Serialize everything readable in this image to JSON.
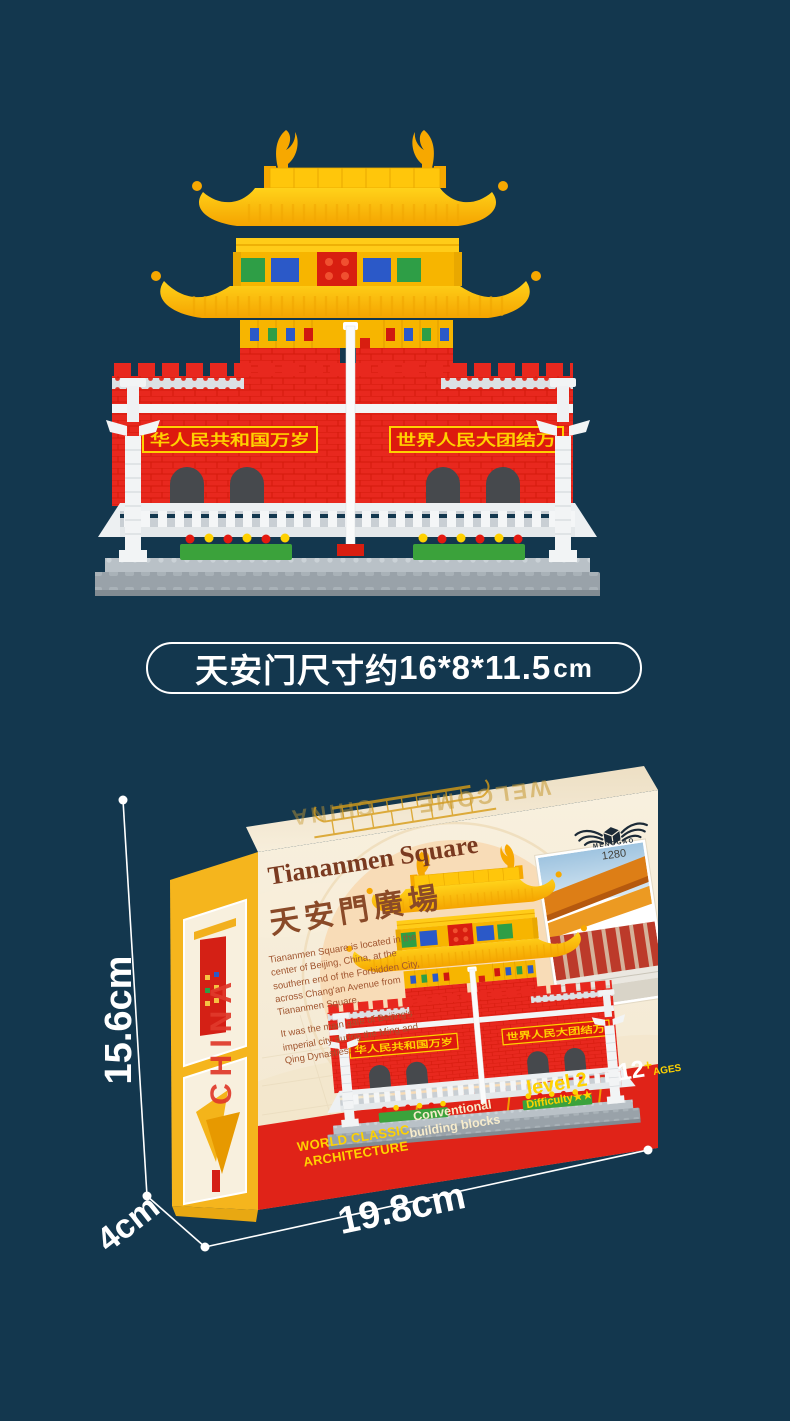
{
  "page": {
    "background_color": "#13374E"
  },
  "size_caption": {
    "prefix": "天安门尺寸约",
    "value": "16*8*11.5",
    "unit": "cm"
  },
  "model_photo": {
    "left_banner": "华人民共和国万岁",
    "right_banner": "世界人民大团结万",
    "colors": {
      "roof_gold": "#FFC60B",
      "wall_red": "#E8281E",
      "base_gray": "#99A2A9",
      "banner_text": "#FFD100"
    }
  },
  "box": {
    "brand": {
      "logo": "winged-cube-icon",
      "name": "MENGGAO",
      "item_number": "1280"
    },
    "front": {
      "title_en": "Tiananmen Square",
      "title_zh": "天安門廣場",
      "paragraph_1": "Tiananmen Square is located in the center of Beijing, China, at the southern end of the Forbidden City, across Chang'an Avenue from Tiananmen Square.",
      "paragraph_2": "It was the main gate of Beijing's imperial city during the Ming and Qing Dynasties.",
      "info_bar": {
        "item1_line1": "WORLD CLASSIC",
        "item1_line2": "ARCHITECTURE",
        "item2_line1": "Conventional",
        "item2_line2": "building blocks",
        "item3_line1": "level 2",
        "item3_line2_label": "Difficulty",
        "item3_stars": "★★",
        "item4_number": "12",
        "item4_plus": "+",
        "item4_label": "AGES"
      }
    },
    "side_panel": {
      "vertical_text": "CHINA"
    },
    "top_panel": {
      "text_left": "CHINA",
      "text_right": "WELCOME"
    }
  },
  "dimensions": {
    "height_label": "15.6cm",
    "depth_label": "4cm",
    "width_label": "19.8cm"
  }
}
